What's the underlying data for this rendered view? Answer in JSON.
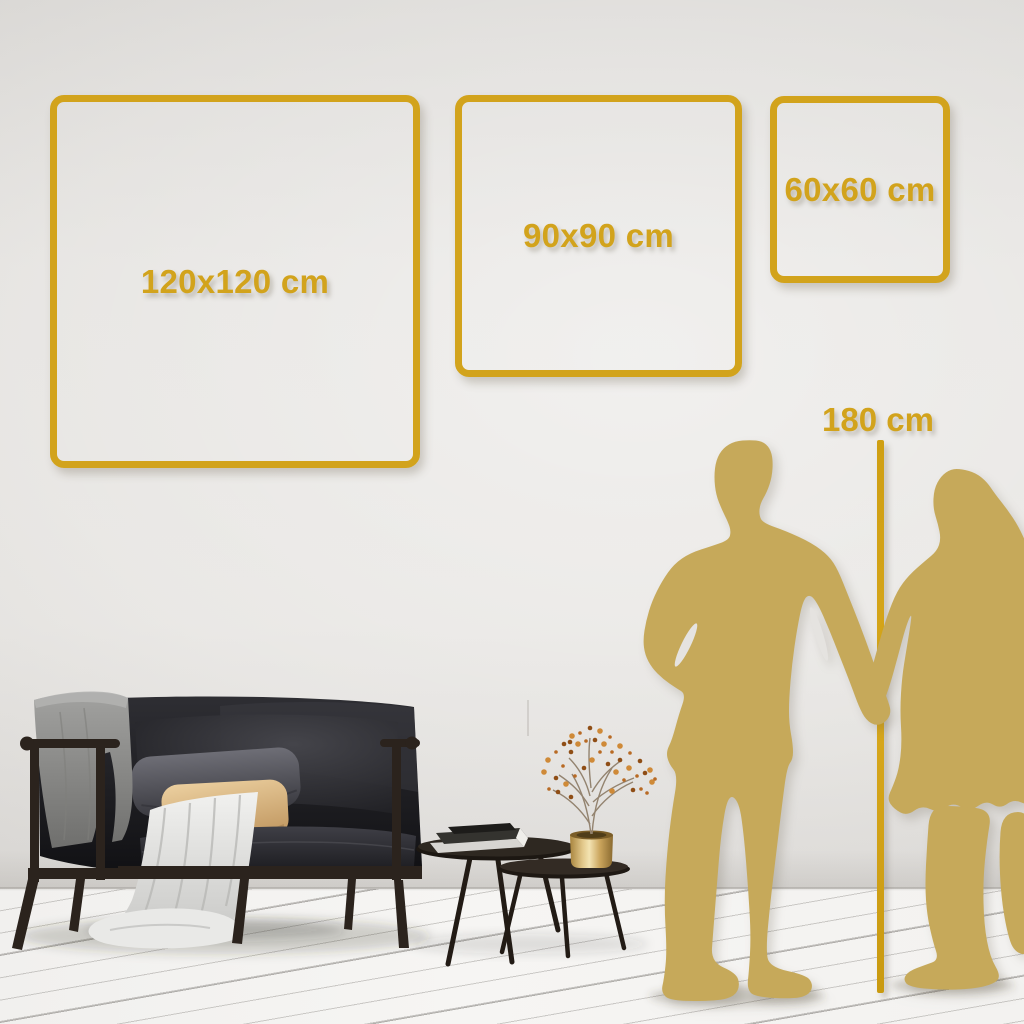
{
  "colors": {
    "gold": "#D2A31C",
    "figure_gold": "#C6A95A",
    "wall": "#E4E2DF",
    "floor": "#F5F4F2"
  },
  "squares": [
    {
      "label": "120x120 cm"
    },
    {
      "label": "90x90 cm"
    },
    {
      "label": "60x60 cm"
    }
  ],
  "height_marker": {
    "label": "180 cm"
  },
  "scene": {
    "illustrations": [
      "dark-sofa-with-blankets-and-pillows",
      "nesting-coffee-tables-with-books",
      "brass-vase-with-dried-branch",
      "man-silhouette",
      "woman-silhouette"
    ]
  }
}
